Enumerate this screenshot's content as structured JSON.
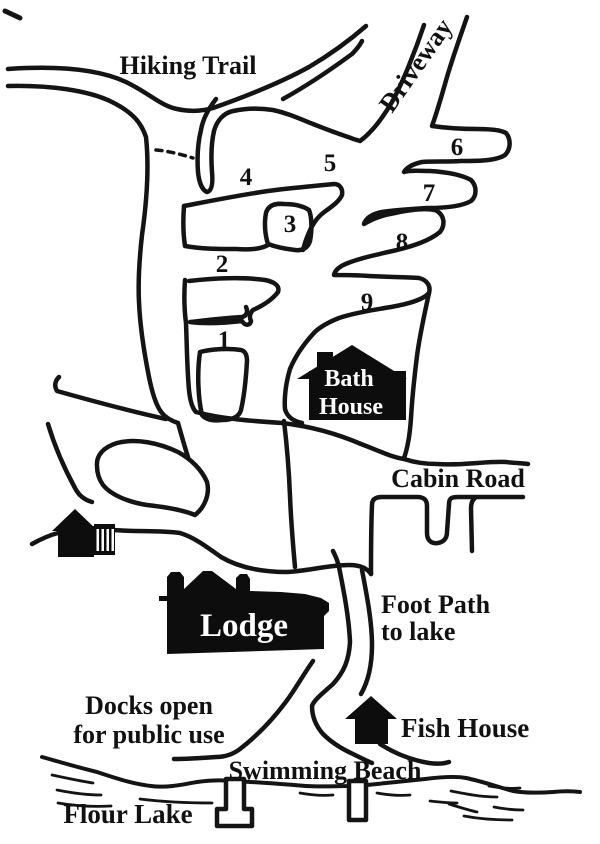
{
  "map": {
    "labels": {
      "hiking_trail": "Hiking Trail",
      "driveway": "Driveway",
      "cabin_road": "Cabin Road",
      "foot_path_line1": "Foot Path",
      "foot_path_line2": "to lake",
      "docks_line1": "Docks open",
      "docks_line2": "for public use",
      "swimming_beach": "Swimming Beach",
      "flour_lake": "Flour Lake"
    },
    "buildings": {
      "bath_house_line1": "Bath",
      "bath_house_line2": "House",
      "lodge": "Lodge",
      "fish_house": "Fish House"
    },
    "campsites": [
      "1",
      "2",
      "3",
      "4",
      "5",
      "6",
      "7",
      "8",
      "9"
    ],
    "colors": {
      "ink": "#141414",
      "paper": "#ffffff",
      "building_fill": "#0d0d0d",
      "building_text": "#ffffff"
    }
  }
}
